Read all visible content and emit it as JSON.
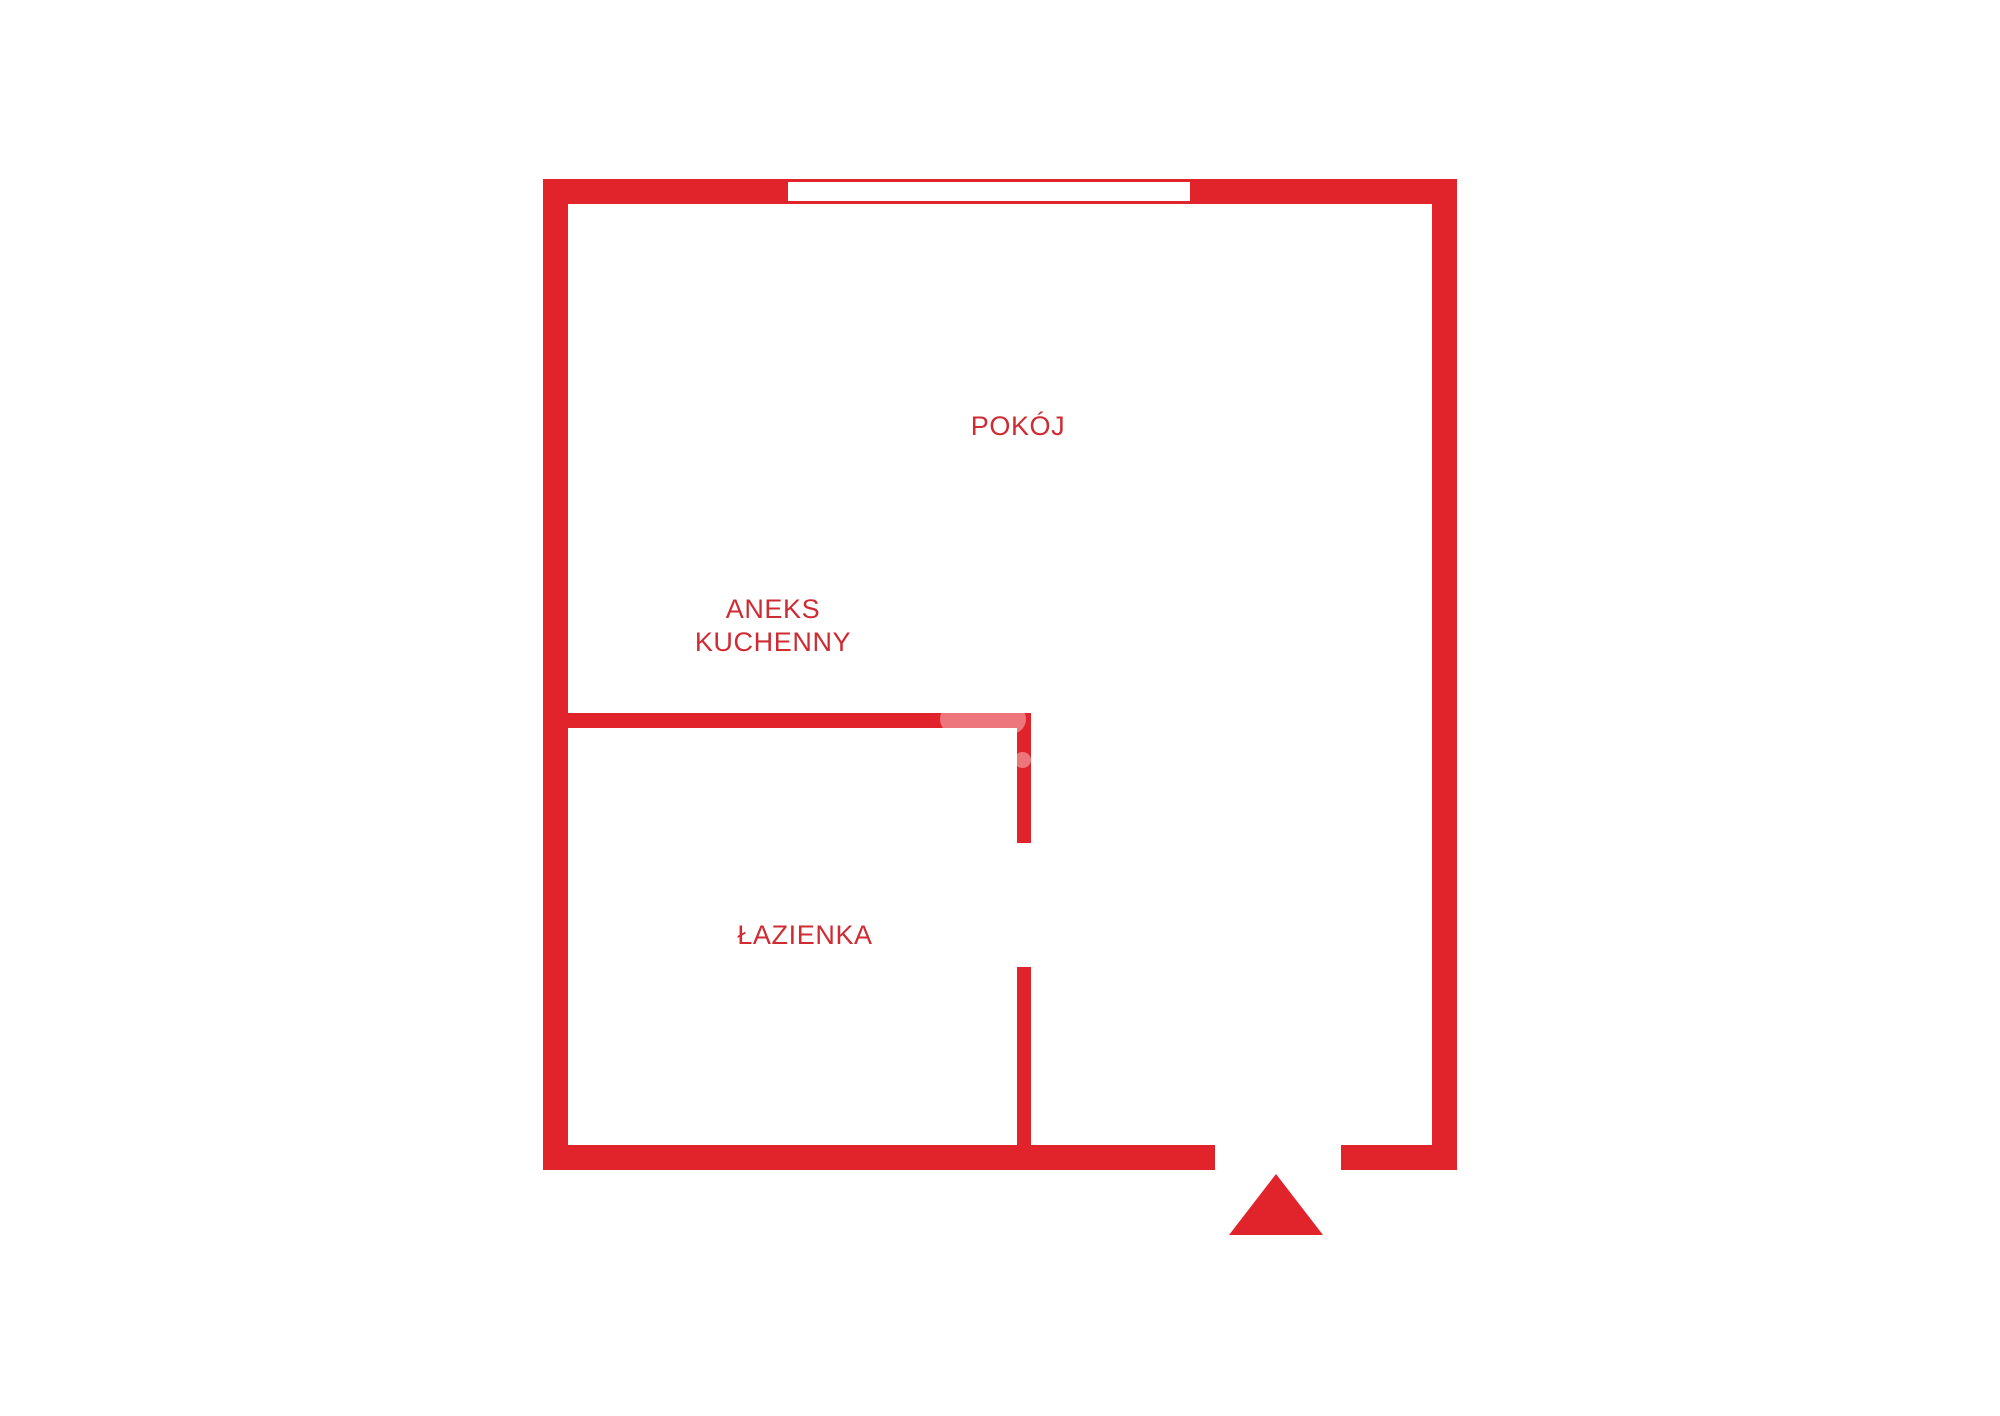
{
  "colors": {
    "wall_red": "#e1232b",
    "label_red": "#ce2b33"
  },
  "rooms": {
    "pokoj": {
      "label": "POKÓJ"
    },
    "aneks_kuchenny": {
      "label_line1": "ANEKS",
      "label_line2": "KUCHENNY"
    },
    "lazienka": {
      "label": "ŁAZIENKA"
    }
  },
  "features": {
    "window": "window-in-top-wall",
    "entrance": "entrance-direction-triangle"
  }
}
